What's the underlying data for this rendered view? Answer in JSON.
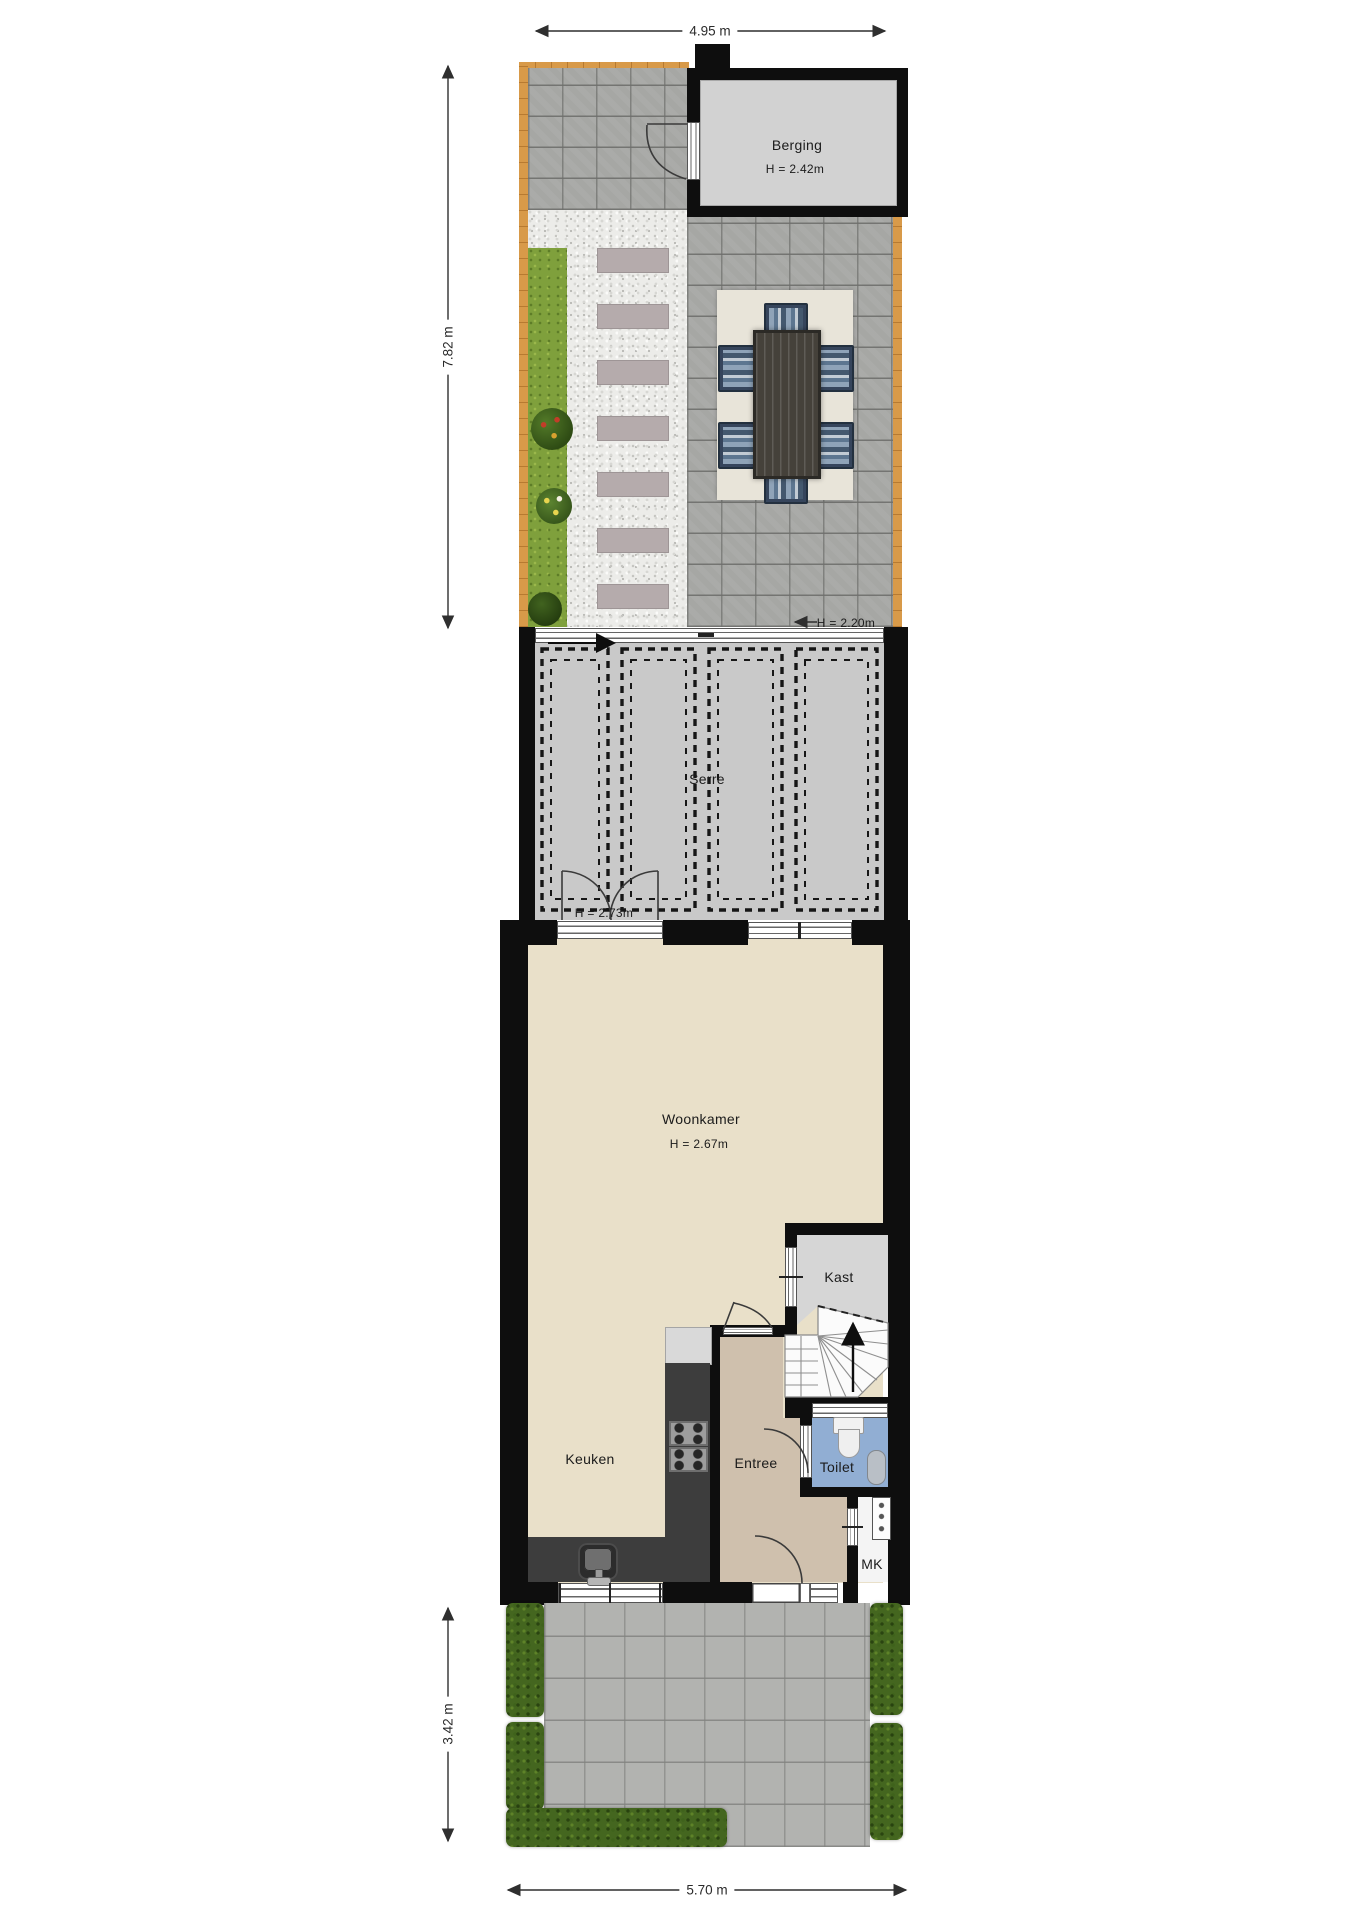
{
  "dimensions": {
    "garden_width": "4.95 m",
    "garden_depth": "7.82 m",
    "front_garden_depth": "3.42 m",
    "house_width": "5.70 m"
  },
  "rooms": {
    "berging": {
      "label": "Berging",
      "ceiling_height": "H = 2.42m"
    },
    "serre": {
      "label": "Serre",
      "ceiling_height": "H = 2.20m",
      "door_height": "H = 2.73m"
    },
    "woonkamer": {
      "label": "Woonkamer",
      "ceiling_height": "H = 2.67m"
    },
    "kast": {
      "label": "Kast"
    },
    "keuken": {
      "label": "Keuken"
    },
    "entree": {
      "label": "Entree"
    },
    "toilet": {
      "label": "Toilet"
    },
    "meterkast": {
      "label": "MK"
    }
  },
  "colors": {
    "wall": "#0e0e0e",
    "living_floor": "#e9e0c9",
    "entry_floor": "#cfc0ad",
    "toilet_floor": "#91aed3",
    "serre_floor": "#c9c9c9",
    "berging_floor": "#d2d2d2",
    "grass": "#7fa03c",
    "hedge": "#44661f",
    "wood_edge": "#d89a49"
  }
}
